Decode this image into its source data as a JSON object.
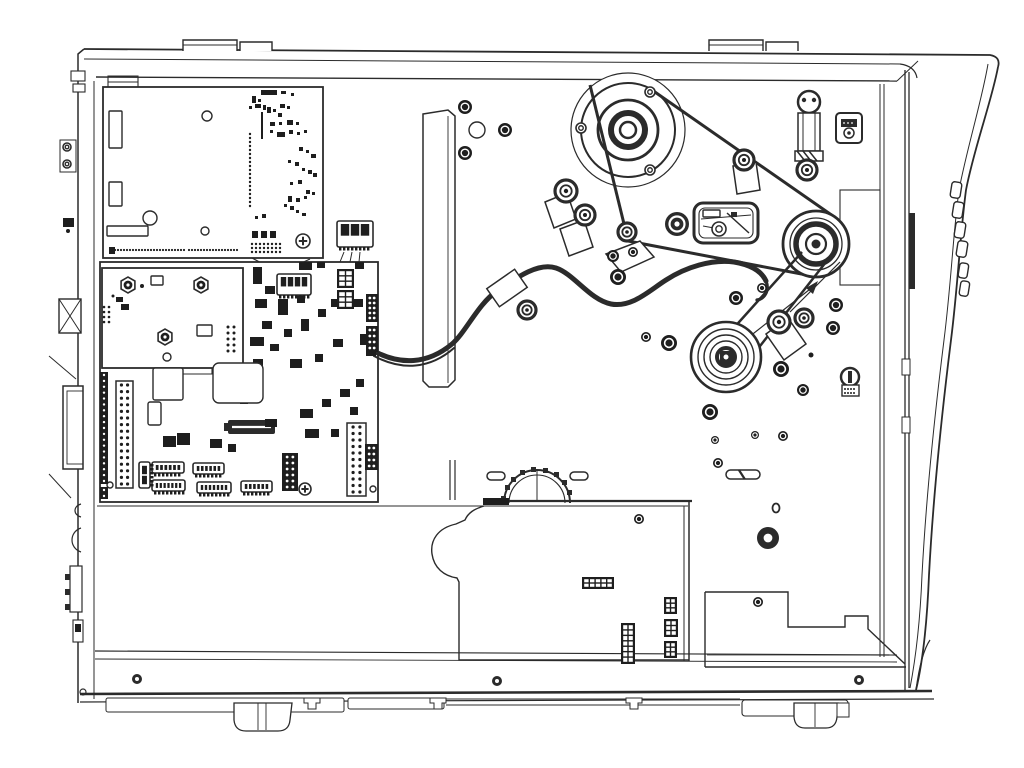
{
  "meta": {
    "title": "Printer internal mechanism - technical line drawing",
    "type": "exploded-service-diagram",
    "description": "Side view of an industrial label printer chassis with electronics bay: main logic board, power supply board, daughter board, drive motor pulley with timing belts, platen and ribbon drive pulleys, idlers, tensioner arm, wiring harness with clamps, encoder gear, lower cover plate, rear panel ports, front bezel with control buttons, base rail and feet."
  },
  "palette": {
    "background": "#ffffff",
    "ink": "#2b2b2b",
    "fill_dark": "#1e1e1e"
  },
  "components": [
    "chassis-frame",
    "top-hinge-tabs",
    "rear-panel",
    "front-bezel",
    "control-buttons",
    "power-supply-board",
    "daughter-board",
    "main-logic-board",
    "bracket-strip",
    "drive-motor-pulley",
    "upper-timing-belt",
    "lower-timing-belt",
    "idler-pulley",
    "platen-drive-pulley",
    "ribbon-drive-pulley",
    "belt-tensioner-arm",
    "damper-spring",
    "wiring-harness",
    "cable-clamp",
    "cable-guide-flag",
    "sensor-block",
    "encoder-gear",
    "cover-plate",
    "stepped-bracket",
    "base-rail",
    "base-feet",
    "media-hanger-bracket"
  ],
  "primitives": {
    "screws": [
      {
        "k": "dark",
        "x": 465,
        "y": 107,
        "r": 7
      },
      {
        "k": "dark",
        "x": 505,
        "y": 130,
        "r": 7
      },
      {
        "k": "dark",
        "x": 465,
        "y": 153,
        "r": 7
      },
      {
        "k": "dark",
        "x": 613,
        "y": 256,
        "r": 6
      },
      {
        "k": "dark",
        "x": 633,
        "y": 252,
        "r": 5
      },
      {
        "k": "dark",
        "x": 618,
        "y": 277,
        "r": 8
      },
      {
        "k": "dark",
        "x": 646,
        "y": 337,
        "r": 5
      },
      {
        "k": "dark",
        "x": 669,
        "y": 343,
        "r": 8
      },
      {
        "k": "dark",
        "x": 736,
        "y": 298,
        "r": 7
      },
      {
        "k": "dark",
        "x": 762,
        "y": 288,
        "r": 5
      },
      {
        "k": "dark",
        "x": 836,
        "y": 305,
        "r": 7
      },
      {
        "k": "dark",
        "x": 833,
        "y": 328,
        "r": 7
      },
      {
        "k": "dark",
        "x": 781,
        "y": 369,
        "r": 8
      },
      {
        "k": "dark",
        "x": 803,
        "y": 390,
        "r": 6
      },
      {
        "k": "dark",
        "x": 783,
        "y": 436,
        "r": 5
      },
      {
        "k": "dark",
        "x": 715,
        "y": 440,
        "r": 4
      },
      {
        "k": "dark",
        "x": 755,
        "y": 435,
        "r": 4
      },
      {
        "k": "dark",
        "x": 710,
        "y": 412,
        "r": 8
      },
      {
        "k": "dark",
        "x": 718,
        "y": 463,
        "r": 5
      },
      {
        "k": "dark",
        "x": 758,
        "y": 602,
        "r": 5
      },
      {
        "k": "dark",
        "x": 639,
        "y": 519,
        "r": 5
      },
      {
        "k": "ring",
        "x": 650,
        "y": 92,
        "r": 5
      },
      {
        "k": "ring",
        "x": 581,
        "y": 128,
        "r": 5
      },
      {
        "k": "ring",
        "x": 650,
        "y": 170,
        "r": 5
      },
      {
        "k": "ring",
        "x": 67,
        "y": 147,
        "r": 4
      },
      {
        "k": "ring",
        "x": 67,
        "y": 164,
        "r": 4
      },
      {
        "k": "ring",
        "x": 719,
        "y": 229,
        "r": 7
      },
      {
        "k": "donut",
        "x": 137,
        "y": 679,
        "r": 5
      },
      {
        "k": "donut",
        "x": 497,
        "y": 681,
        "r": 5
      },
      {
        "k": "donut",
        "x": 859,
        "y": 680,
        "r": 5
      },
      {
        "k": "donut",
        "x": 768,
        "y": 538,
        "r": 11
      },
      {
        "k": "hole",
        "x": 477,
        "y": 130,
        "r": 8
      },
      {
        "k": "hole",
        "x": 150,
        "y": 218,
        "r": 7
      },
      {
        "k": "hole",
        "x": 207,
        "y": 116,
        "r": 5
      },
      {
        "k": "hole",
        "x": 205,
        "y": 231,
        "r": 4
      },
      {
        "k": "hole",
        "x": 167,
        "y": 357,
        "r": 4
      },
      {
        "k": "hole",
        "x": 110,
        "y": 485,
        "r": 3
      },
      {
        "k": "hole",
        "x": 373,
        "y": 489,
        "r": 3
      },
      {
        "k": "phil",
        "x": 303,
        "y": 241,
        "r": 7
      },
      {
        "k": "phil",
        "x": 305,
        "y": 489,
        "r": 6
      },
      {
        "k": "dot",
        "x": 142,
        "y": 286,
        "r": 2
      },
      {
        "k": "dot",
        "x": 68,
        "y": 231,
        "r": 2
      },
      {
        "k": "dot",
        "x": 113,
        "y": 296,
        "r": 1.5
      },
      {
        "k": "dot",
        "x": 811,
        "y": 355,
        "r": 2.5
      }
    ],
    "bearings": [
      {
        "x": 627,
        "y": 232,
        "r": 9
      },
      {
        "x": 566,
        "y": 191,
        "r": 11
      },
      {
        "x": 585,
        "y": 215,
        "r": 10
      },
      {
        "x": 744,
        "y": 160,
        "r": 10
      },
      {
        "x": 779,
        "y": 322,
        "r": 11
      },
      {
        "x": 804,
        "y": 318,
        "r": 9
      },
      {
        "x": 807,
        "y": 170,
        "r": 10
      },
      {
        "x": 527,
        "y": 310,
        "r": 9
      }
    ],
    "standoffs": [
      {
        "x": 128,
        "y": 285,
        "r": 8
      },
      {
        "x": 201,
        "y": 285,
        "r": 8
      },
      {
        "x": 165,
        "y": 337,
        "r": 8
      }
    ],
    "ics": [
      [
        253,
        267,
        9,
        17
      ],
      [
        265,
        286,
        10,
        8
      ],
      [
        299,
        262,
        13,
        8
      ],
      [
        317,
        262,
        8,
        6
      ],
      [
        355,
        262,
        9,
        7
      ],
      [
        255,
        299,
        12,
        9
      ],
      [
        278,
        299,
        10,
        16
      ],
      [
        297,
        295,
        8,
        8
      ],
      [
        262,
        321,
        10,
        8
      ],
      [
        250,
        337,
        14,
        9
      ],
      [
        284,
        329,
        8,
        8
      ],
      [
        270,
        344,
        9,
        7
      ],
      [
        301,
        319,
        8,
        12
      ],
      [
        318,
        309,
        8,
        8
      ],
      [
        331,
        299,
        9,
        8
      ],
      [
        253,
        359,
        10,
        8
      ],
      [
        290,
        359,
        12,
        9
      ],
      [
        315,
        354,
        8,
        8
      ],
      [
        333,
        339,
        10,
        8
      ],
      [
        352,
        299,
        11,
        8
      ],
      [
        360,
        334,
        9,
        11
      ],
      [
        300,
        409,
        13,
        9
      ],
      [
        322,
        399,
        9,
        8
      ],
      [
        340,
        389,
        10,
        8
      ],
      [
        356,
        379,
        8,
        8
      ],
      [
        265,
        419,
        12,
        8
      ],
      [
        305,
        429,
        14,
        9
      ],
      [
        331,
        429,
        8,
        8
      ],
      [
        350,
        407,
        8,
        8
      ],
      [
        163,
        436,
        13,
        11
      ],
      [
        177,
        433,
        13,
        12
      ],
      [
        210,
        439,
        12,
        9
      ],
      [
        228,
        444,
        8,
        8
      ],
      [
        255,
        379,
        8,
        8
      ],
      [
        240,
        396,
        8,
        8
      ],
      [
        116,
        297,
        7,
        5
      ],
      [
        121,
        304,
        8,
        6
      ],
      [
        63,
        218,
        11,
        9
      ],
      [
        75,
        624,
        6,
        8
      ],
      [
        366,
        342,
        10,
        14
      ],
      [
        483,
        498,
        26,
        7
      ]
    ],
    "white_boxes": [
      [
        213,
        363,
        50,
        40,
        6
      ],
      [
        153,
        368,
        30,
        32,
        2
      ],
      [
        148,
        402,
        13,
        23,
        2
      ],
      [
        151,
        276,
        12,
        9,
        1
      ],
      [
        197,
        325,
        15,
        11,
        1
      ],
      [
        109,
        111,
        13,
        37,
        1
      ],
      [
        109,
        182,
        13,
        24,
        1
      ],
      [
        107,
        226,
        41,
        10,
        1
      ],
      [
        703,
        210,
        17,
        7,
        1
      ]
    ],
    "capsules": [
      {
        "x": 487,
        "y": 472,
        "w": 18,
        "h": 8,
        "slash": false
      },
      {
        "x": 570,
        "y": 472,
        "w": 18,
        "h": 8,
        "slash": false
      },
      {
        "x": 726,
        "y": 470,
        "w": 34,
        "h": 9,
        "slash": true
      }
    ],
    "connectors": [
      {
        "x": 337,
        "y": 221,
        "w": 36,
        "h": 26,
        "slots": 3,
        "dir": "down"
      },
      {
        "x": 277,
        "y": 274,
        "w": 34,
        "h": 21,
        "slots": 4,
        "dir": "down"
      },
      {
        "x": 152,
        "y": 462,
        "w": 32,
        "h": 11,
        "slots": 6,
        "dir": "down"
      },
      {
        "x": 193,
        "y": 463,
        "w": 31,
        "h": 11,
        "slots": 6,
        "dir": "down"
      },
      {
        "x": 152,
        "y": 480,
        "w": 33,
        "h": 11,
        "slots": 7,
        "dir": "down"
      },
      {
        "x": 197,
        "y": 482,
        "w": 34,
        "h": 11,
        "slots": 7,
        "dir": "down"
      },
      {
        "x": 241,
        "y": 481,
        "w": 31,
        "h": 11,
        "slots": 6,
        "dir": "down"
      },
      {
        "x": 139,
        "y": 462,
        "w": 11,
        "h": 26,
        "slots": 2,
        "dir": "right"
      }
    ],
    "pin_headers": [
      {
        "x": 116,
        "y": 381,
        "w": 17,
        "h": 107,
        "rows": 16,
        "style": "white"
      },
      {
        "x": 347,
        "y": 423,
        "w": 19,
        "h": 73,
        "rows": 11,
        "style": "white"
      },
      {
        "x": 282,
        "y": 453,
        "w": 16,
        "h": 38,
        "rows": 6,
        "style": "dark"
      },
      {
        "x": 366,
        "y": 294,
        "w": 12,
        "h": 28,
        "rows": 5,
        "style": "dark"
      },
      {
        "x": 366,
        "y": 326,
        "w": 12,
        "h": 26,
        "rows": 4,
        "style": "dark"
      },
      {
        "x": 365,
        "y": 444,
        "w": 13,
        "h": 26,
        "rows": 4,
        "style": "dark"
      },
      {
        "x": 100,
        "y": 372,
        "w": 8,
        "h": 112,
        "rows": 19,
        "style": "edge"
      },
      {
        "x": 100,
        "y": 487,
        "w": 8,
        "h": 12,
        "rows": 2,
        "style": "edge"
      }
    ],
    "grid_blocks": [
      {
        "x": 582,
        "y": 577,
        "w": 32,
        "h": 12,
        "cols": 5,
        "rows": 2
      },
      {
        "x": 664,
        "y": 597,
        "w": 13,
        "h": 17,
        "cols": 2,
        "rows": 3
      },
      {
        "x": 664,
        "y": 619,
        "w": 14,
        "h": 18,
        "cols": 2,
        "rows": 3
      },
      {
        "x": 664,
        "y": 641,
        "w": 13,
        "h": 17,
        "cols": 2,
        "rows": 3
      },
      {
        "x": 621,
        "y": 623,
        "w": 14,
        "h": 41,
        "cols": 2,
        "rows": 7
      },
      {
        "x": 337,
        "y": 269,
        "w": 17,
        "h": 19,
        "cols": 2,
        "rows": 3
      },
      {
        "x": 337,
        "y": 290,
        "w": 17,
        "h": 19,
        "cols": 2,
        "rows": 3
      }
    ],
    "smd": [
      [
        261,
        90,
        16,
        5
      ],
      [
        281,
        91,
        5,
        3
      ],
      [
        291,
        93,
        3,
        3
      ],
      [
        252,
        96,
        4,
        7
      ],
      [
        258,
        99,
        3,
        3
      ],
      [
        249,
        106,
        3,
        3
      ],
      [
        255,
        104,
        6,
        4
      ],
      [
        263,
        105,
        3,
        5
      ],
      [
        267,
        107,
        4,
        6
      ],
      [
        273,
        109,
        3,
        3
      ],
      [
        280,
        104,
        5,
        4
      ],
      [
        287,
        106,
        3,
        3
      ],
      [
        278,
        113,
        4,
        4
      ],
      [
        261,
        112,
        2,
        27
      ],
      [
        270,
        122,
        5,
        4
      ],
      [
        279,
        122,
        3,
        3
      ],
      [
        287,
        120,
        6,
        5
      ],
      [
        296,
        122,
        3,
        3
      ],
      [
        270,
        130,
        3,
        3
      ],
      [
        277,
        132,
        8,
        5
      ],
      [
        289,
        130,
        4,
        4
      ],
      [
        297,
        132,
        3,
        3
      ],
      [
        304,
        130,
        3,
        3
      ],
      [
        299,
        147,
        4,
        4
      ],
      [
        306,
        150,
        3,
        3
      ],
      [
        311,
        154,
        5,
        4
      ],
      [
        288,
        160,
        3,
        3
      ],
      [
        295,
        162,
        4,
        4
      ],
      [
        302,
        168,
        3,
        3
      ],
      [
        308,
        170,
        4,
        4
      ],
      [
        313,
        173,
        4,
        4
      ],
      [
        298,
        180,
        4,
        4
      ],
      [
        290,
        182,
        3,
        3
      ],
      [
        306,
        190,
        4,
        4
      ],
      [
        312,
        192,
        3,
        3
      ],
      [
        288,
        196,
        4,
        6
      ],
      [
        296,
        198,
        4,
        4
      ],
      [
        304,
        196,
        3,
        3
      ],
      [
        284,
        204,
        3,
        3
      ],
      [
        290,
        206,
        4,
        4
      ],
      [
        255,
        216,
        3,
        3
      ],
      [
        262,
        214,
        4,
        4
      ],
      [
        252,
        231,
        6,
        7
      ],
      [
        261,
        231,
        6,
        7
      ],
      [
        270,
        231,
        6,
        7
      ],
      [
        109,
        247,
        6,
        7
      ],
      [
        296,
        210,
        3,
        3
      ],
      [
        302,
        213,
        4,
        3
      ]
    ],
    "dot_rows": [
      {
        "x1": 112,
        "x2": 184,
        "y": 250,
        "step": 3,
        "r": 1.1
      },
      {
        "x1": 189,
        "x2": 238,
        "y": 250,
        "step": 3,
        "r": 1.1
      },
      {
        "x1": 252,
        "x2": 280,
        "y": 244,
        "step": 4,
        "r": 1.2
      },
      {
        "x1": 252,
        "x2": 280,
        "y": 248,
        "step": 4,
        "r": 1.2
      },
      {
        "x1": 252,
        "x2": 280,
        "y": 252,
        "step": 4,
        "r": 1.2
      },
      {
        "x1": 845,
        "x2": 855,
        "y": 389,
        "step": 3,
        "r": 1
      },
      {
        "x1": 845,
        "x2": 855,
        "y": 393,
        "step": 3,
        "r": 1
      }
    ],
    "dot_cols": [
      {
        "x": 250,
        "y1": 134,
        "y2": 206,
        "step": 4,
        "r": 1.2
      },
      {
        "x": 104,
        "y1": 307,
        "y2": 322,
        "step": 5,
        "r": 1.3
      },
      {
        "x": 109,
        "y1": 307,
        "y2": 322,
        "step": 5,
        "r": 1.3
      },
      {
        "x": 228,
        "y1": 327,
        "y2": 351,
        "step": 6,
        "r": 1.5
      },
      {
        "x": 234,
        "y1": 327,
        "y2": 351,
        "step": 6,
        "r": 1.5
      }
    ]
  }
}
